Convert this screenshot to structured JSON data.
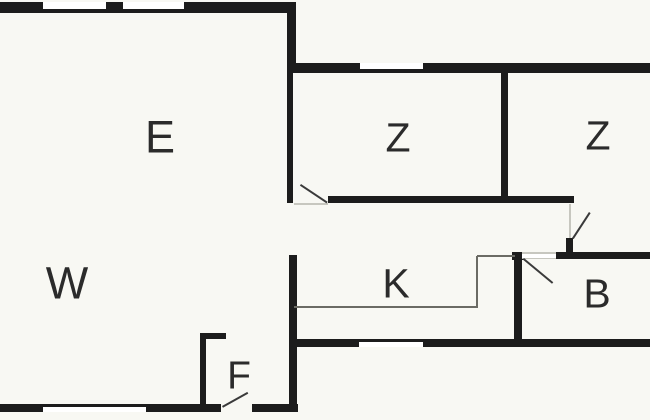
{
  "plan": {
    "type": "floor-plan",
    "colors": {
      "background": "#f8f8f3",
      "wall": "#1c1c1c",
      "window_fill": "#ffffff",
      "thin_dark": "#6b6b64",
      "thin_light": "#c7c7bf",
      "door_swing": "#3a3a3a",
      "label": "#2b2b2b"
    },
    "rooms": [
      {
        "label": "E",
        "cx": 160,
        "cy": 137,
        "fs": 45,
        "name": "room-label-e"
      },
      {
        "label": "Z",
        "cx": 398,
        "cy": 138,
        "fs": 41,
        "name": "room-label-z1"
      },
      {
        "label": "Z",
        "cx": 598,
        "cy": 136,
        "fs": 41,
        "name": "room-label-z2"
      },
      {
        "label": "W",
        "cx": 67,
        "cy": 283,
        "fs": 45,
        "name": "room-label-w"
      },
      {
        "label": "K",
        "cx": 396,
        "cy": 284,
        "fs": 41,
        "name": "room-label-k"
      },
      {
        "label": "B",
        "cx": 597,
        "cy": 294,
        "fs": 41,
        "name": "room-label-b"
      },
      {
        "label": "F",
        "cx": 239,
        "cy": 376,
        "fs": 39,
        "name": "room-label-f"
      }
    ],
    "walls": [
      {
        "x": 0,
        "y": 2,
        "w": 296,
        "h": 11,
        "name": "exterior-wall-top-left"
      },
      {
        "x": 287,
        "y": 13,
        "w": 9,
        "h": 60,
        "name": "wall-e-right-upper"
      },
      {
        "x": 287,
        "y": 73,
        "w": 6,
        "h": 130,
        "name": "wall-e-z1"
      },
      {
        "x": 287,
        "y": 63,
        "w": 363,
        "h": 10,
        "name": "exterior-wall-top-right-wing"
      },
      {
        "x": 501,
        "y": 73,
        "w": 7,
        "h": 123,
        "name": "wall-z1-z2"
      },
      {
        "x": 328,
        "y": 196,
        "w": 246,
        "h": 7,
        "name": "wall-z-corridor"
      },
      {
        "x": 289,
        "y": 255,
        "w": 8,
        "h": 157,
        "name": "wall-w-corridor"
      },
      {
        "x": 289,
        "y": 339,
        "w": 361,
        "h": 8,
        "name": "exterior-wall-bottom-right-wing"
      },
      {
        "x": 512,
        "y": 252,
        "w": 13,
        "h": 8,
        "name": "wall-cap-k-b"
      },
      {
        "x": 514,
        "y": 252,
        "w": 8,
        "h": 95,
        "name": "wall-k-b"
      },
      {
        "x": 556,
        "y": 252,
        "w": 94,
        "h": 7,
        "name": "wall-b-top"
      },
      {
        "x": 566,
        "y": 238,
        "w": 7,
        "h": 14,
        "name": "door-jamb-z2"
      },
      {
        "x": 200,
        "y": 333,
        "w": 6,
        "h": 71,
        "name": "wall-f-left"
      },
      {
        "x": 200,
        "y": 333,
        "w": 26,
        "h": 6,
        "name": "wall-f-top-stub"
      },
      {
        "x": 0,
        "y": 404,
        "w": 221,
        "h": 8,
        "name": "exterior-wall-bottom-left-a"
      },
      {
        "x": 252,
        "y": 404,
        "w": 46,
        "h": 8,
        "name": "exterior-wall-bottom-left-b"
      }
    ],
    "windows": [
      {
        "x": 43,
        "y": 2,
        "w": 63,
        "h": 7,
        "name": "window-top-1"
      },
      {
        "x": 123,
        "y": 2,
        "w": 61,
        "h": 7,
        "name": "window-top-2"
      },
      {
        "x": 360,
        "y": 63,
        "w": 63,
        "h": 6,
        "name": "window-z1"
      },
      {
        "x": 359,
        "y": 342,
        "w": 64,
        "h": 5,
        "name": "window-k"
      },
      {
        "x": 43,
        "y": 407,
        "w": 103,
        "h": 5,
        "name": "window-w"
      },
      {
        "x": 522,
        "y": 252,
        "w": 34,
        "h": 7,
        "name": "door-opening-b"
      }
    ],
    "thin_lines": [
      {
        "x": 294,
        "y": 306,
        "w": 184,
        "h": 2,
        "tone": "dark",
        "name": "kitchen-boundary-bottom"
      },
      {
        "x": 476,
        "y": 256,
        "w": 2,
        "h": 52,
        "tone": "dark",
        "name": "kitchen-boundary-right"
      },
      {
        "x": 477,
        "y": 255,
        "w": 38,
        "h": 2,
        "tone": "dark",
        "name": "kitchen-boundary-top"
      },
      {
        "x": 294,
        "y": 203,
        "w": 34,
        "h": 2,
        "tone": "light",
        "name": "threshold-z1"
      },
      {
        "x": 569,
        "y": 204,
        "w": 2,
        "h": 34,
        "tone": "light",
        "name": "threshold-z2"
      },
      {
        "x": 522,
        "y": 252,
        "w": 34,
        "h": 1.5,
        "tone": "light",
        "name": "threshold-b-top"
      },
      {
        "x": 522,
        "y": 257.5,
        "w": 34,
        "h": 1.5,
        "tone": "light",
        "name": "threshold-b-bottom"
      }
    ],
    "door_swings": [
      {
        "x1": 301,
        "y1": 184,
        "x2": 328,
        "y2": 202,
        "name": "door-swing-z1"
      },
      {
        "x1": 572,
        "y1": 238,
        "x2": 589,
        "y2": 212,
        "name": "door-swing-z2"
      },
      {
        "x1": 524,
        "y1": 258,
        "x2": 553,
        "y2": 282,
        "name": "door-swing-b"
      },
      {
        "x1": 222,
        "y1": 406,
        "x2": 247,
        "y2": 392,
        "name": "door-swing-f"
      }
    ]
  }
}
